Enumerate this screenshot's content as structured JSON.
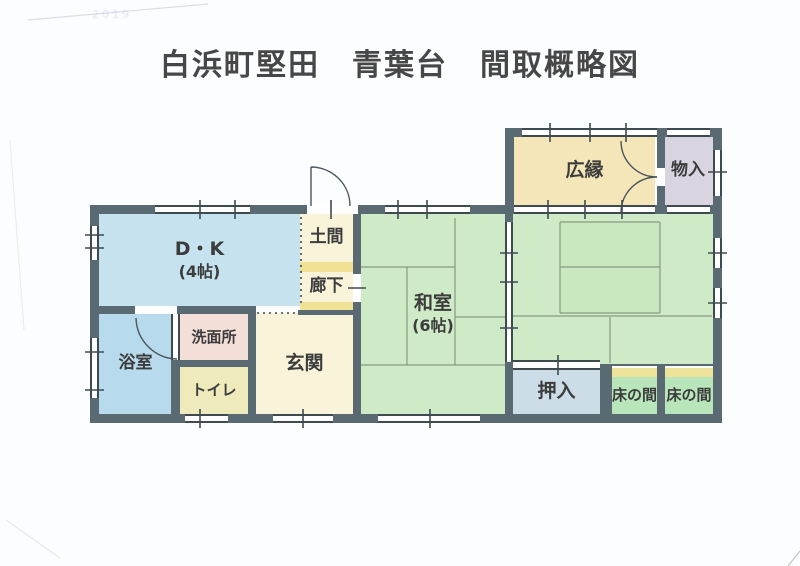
{
  "title": "白浜町堅田　青葉台　間取概略図",
  "faint_stamp": "2019",
  "colors": {
    "wall": "#5a6a72",
    "title_text": "#474747",
    "label_text": "#3c3c3c",
    "line": "#4a555c",
    "seam": "#74876f",
    "dotted": "#3f4a50",
    "tick": "#3f4a50",
    "scan": "#c9d2da",
    "dk": "#c6e2ef",
    "bath": "#b7daec",
    "washitsu": "#cfeac6",
    "washitsu_core": "#c9e8c0",
    "hiroen": "#f4e6b8",
    "monoire": "#d8d5e1",
    "cream": "#f9f3da",
    "yellow_band": "#f1e195",
    "toilet": "#eeeabc",
    "senmen": "#f3dfd8",
    "oshiire": "#cddde7",
    "tokonoma": "#b9e5bb",
    "tokonoma_band": "#eee39a"
  },
  "rooms": {
    "dk": {
      "label": "D・K",
      "size": "(4帖)"
    },
    "doma": {
      "label": "土間"
    },
    "rouka": {
      "label": "廊下"
    },
    "washitsu_center": {
      "label": "和室",
      "size": "(6帖)"
    },
    "washitsu_right": {
      "label": "和室",
      "size": "(6帖)"
    },
    "hiroen": {
      "label": "広縁"
    },
    "monoire": {
      "label": "物入"
    },
    "yokushitsu": {
      "label": "浴室"
    },
    "senmenjo": {
      "label": "洗面所"
    },
    "toire": {
      "label": "トイレ"
    },
    "genkan": {
      "label": "玄関"
    },
    "oshiire": {
      "label": "押入"
    },
    "tokonoma_1": {
      "label": "床の間"
    },
    "tokonoma_2": {
      "label": "床の間"
    }
  }
}
